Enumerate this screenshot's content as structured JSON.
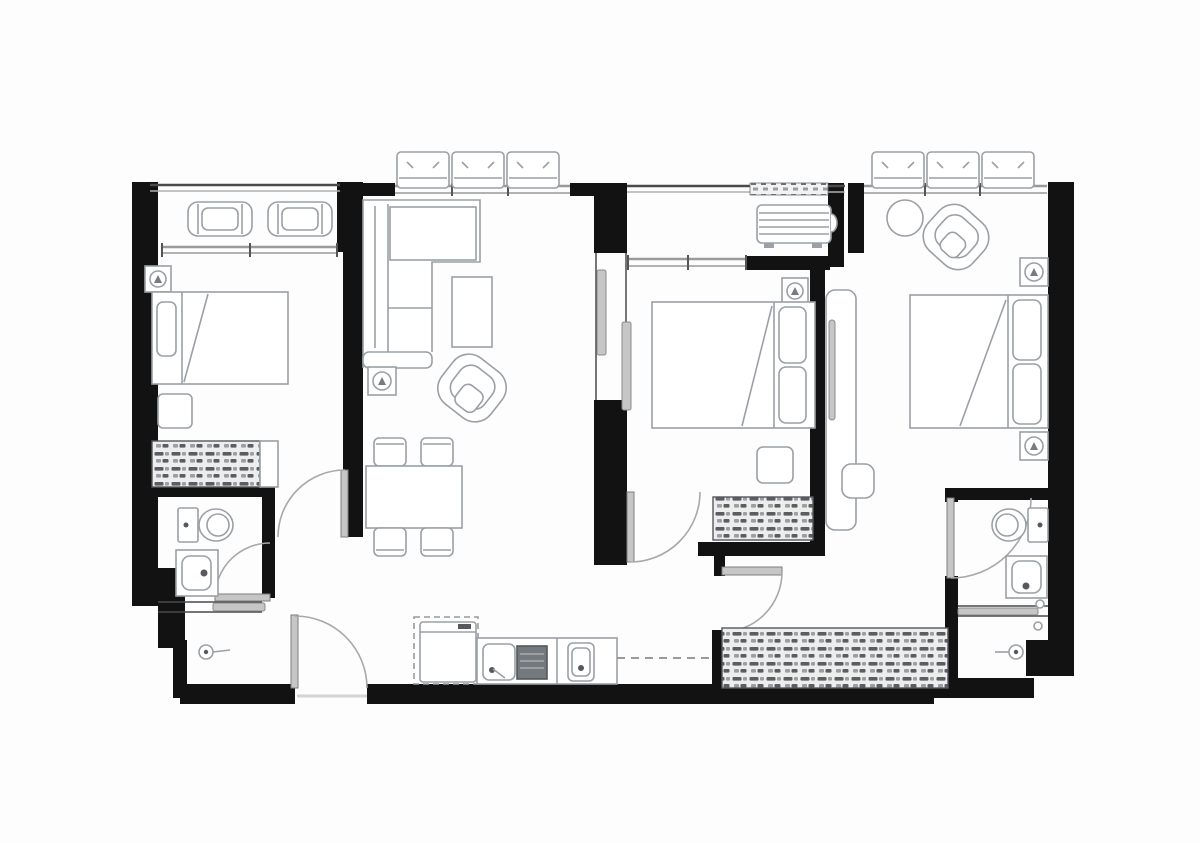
{
  "meta": {
    "title": "Apartment floor plan",
    "type": "architectural-floor-plan",
    "orientation": "landscape"
  },
  "colors": {
    "canvas": "#fdfdfd",
    "wall": "#121212",
    "thin_wall": "#4a4a4a",
    "window": "#9a9a9a",
    "window_light": "#c9c9c9",
    "furniture": "#9aa0a6",
    "furniture_dark": "#6b7075",
    "door": "#a8a8a8",
    "door_leaf": "#c6c6c6",
    "hatch_dark": "#5a5d61",
    "hatch_light": "#9b9ea2",
    "hatch_bg": "#ededed",
    "stove": "#74797e",
    "dash_line": "#9a9a9a",
    "white": "#ffffff"
  },
  "plan": {
    "bedrooms": 3,
    "bathrooms": 2,
    "balconies": 2,
    "ac_condenser_units": 7,
    "entrance_doors": 1,
    "rooms": [
      {
        "id": "balcony-left",
        "items": [
          "lounge-chair",
          "lounge-chair",
          "railing"
        ]
      },
      {
        "id": "bedroom-left",
        "items": [
          "double-bed",
          "pillow",
          "wall-lamp",
          "nightstand",
          "dresser-hatched",
          "door-swing"
        ]
      },
      {
        "id": "living-dining",
        "items": [
          "sectional-sofa",
          "coffee-table",
          "armchair",
          "ceiling-lamp",
          "dining-table",
          "dining-chair",
          "dining-chair",
          "dining-chair",
          "dining-chair"
        ]
      },
      {
        "id": "kitchen",
        "items": [
          "refrigerator",
          "kitchen-sink",
          "cooktop",
          "counter",
          "overhead-cabinet-dash"
        ]
      },
      {
        "id": "bathroom-left",
        "items": [
          "toilet",
          "washbasin",
          "shower-head",
          "sliding-partition",
          "door-swing"
        ]
      },
      {
        "id": "balcony-middle",
        "items": [
          "ac-condenser",
          "vent-grille",
          "window-sill"
        ]
      },
      {
        "id": "bedroom-middle",
        "items": [
          "double-bed",
          "pillow",
          "pillow",
          "wall-lamp",
          "nightstand",
          "dresser-hatched",
          "pocket-door",
          "door-swing"
        ]
      },
      {
        "id": "hallway",
        "items": [
          "long-wardrobe-hatched",
          "tall-wardrobe",
          "desk-chair",
          "door-swing",
          "entrance-door-swing"
        ]
      },
      {
        "id": "bedroom-right",
        "items": [
          "double-bed",
          "pillow",
          "pillow",
          "armchair",
          "round-side-table",
          "wall-lamp",
          "wall-lamp"
        ]
      },
      {
        "id": "bathroom-right",
        "items": [
          "toilet",
          "washbasin",
          "shower-head",
          "sliding-partition",
          "door-swing"
        ]
      }
    ]
  }
}
